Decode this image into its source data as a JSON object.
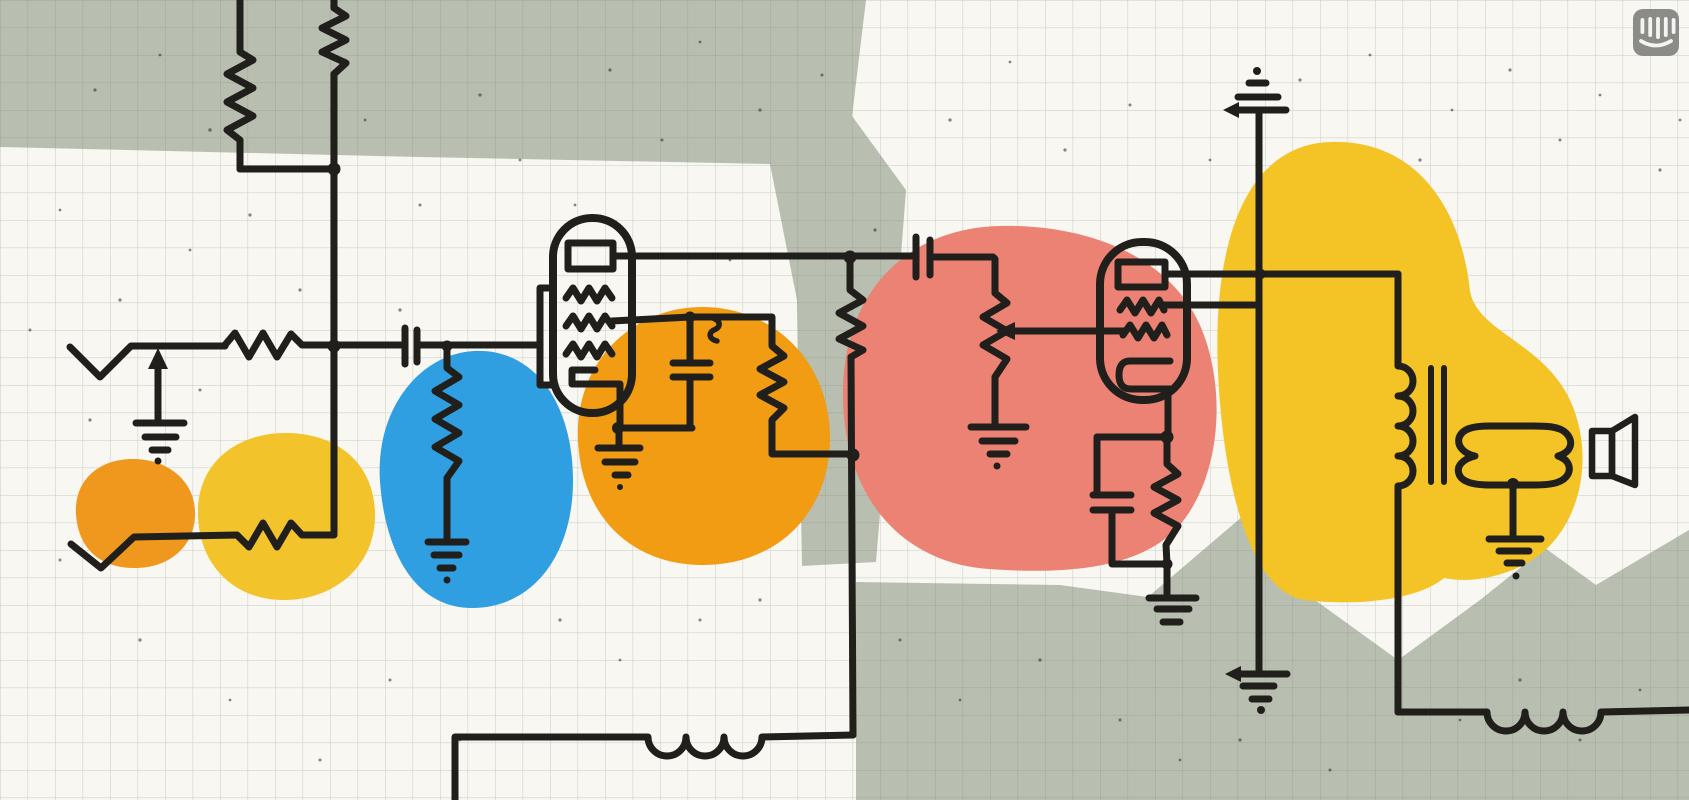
{
  "artwork": {
    "kind": "stylized-circuit-schematic-illustration",
    "subject": "two-stage vacuum tube audio amplifier drawn in ink on graph paper with paper-cut color blobs"
  },
  "palette": {
    "paper": "#f8f7f2",
    "grid_line": "rgba(105,120,100,0.28)",
    "ink": "#201f1b",
    "speck": "#26251f",
    "gray_shape": "#b8bfb1",
    "blob_orange_small": "#ef981d",
    "blob_yellow_small": "#f3c32b",
    "blob_blue": "#2f9fe2",
    "blob_orange_large": "#f29c13",
    "blob_salmon": "#ec8273",
    "blob_yellow_large": "#f4c427",
    "logo_gray": "#8b8c87",
    "logo_glyph": "#f4f4f2"
  },
  "icons": {
    "watermark": "intercom-logo"
  },
  "schematic_parts": [
    "input-jack-1",
    "input-jack-2",
    "ground-input",
    "series-resistor-input",
    "dropper-resistor-left-1",
    "dropper-resistor-left-2",
    "coupling-capacitor-input",
    "grid-leak-resistor-blue",
    "triode-tube-1",
    "cathode-bypass-capacitor-1",
    "cathode-ground-1",
    "anode-load-resistor-1",
    "screen-resistor-1",
    "coupling-capacitor-interstage",
    "volume-potentiometer",
    "potentiometer-ground",
    "triode-tube-2",
    "cathode-rc-network",
    "cathode-ground-2",
    "supply-terminal",
    "supply-ground",
    "output-transformer",
    "voice-coil",
    "loudspeaker",
    "speaker-ground",
    "choke-inductor-bottom",
    "choke-inductor-right"
  ]
}
